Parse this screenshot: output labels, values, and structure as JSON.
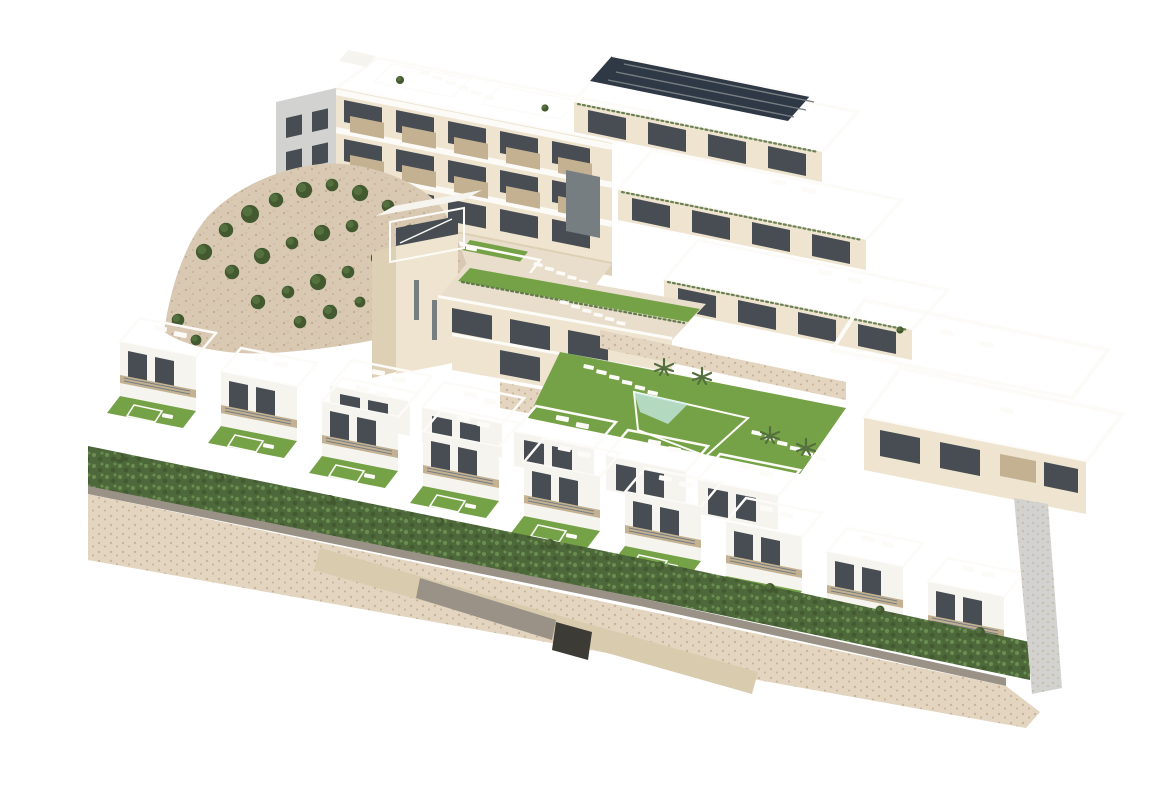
{
  "meta": {
    "title": "Aerial 3D architectural render of a hillside residential development",
    "background": "#ffffff"
  },
  "palette": {
    "bg": "#ffffff",
    "white_wall": "#f6f4ee",
    "parapet": "#fcfbf8",
    "cream_wall": "#eee4cf",
    "cream_wall_dark": "#ddd0b4",
    "tan_balcony": "#c3b192",
    "roof_deck": "#e8decb",
    "roof_deck_light": "#f0e9d8",
    "grey_wall": "#d2d3d0",
    "glass_dark": "#474d52",
    "glass_mid": "#767e82",
    "pool_water": "#8ed2d8",
    "pool_light": "#c8ecea",
    "pool_deep": "#55b8c6",
    "lawn": "#76a247",
    "lawn_dark": "#5d8a38",
    "hedge": "#4d683a",
    "hedge_light": "#6b8d50",
    "tree": "#55703f",
    "tree_dark": "#43592f",
    "rock_sand": "#d9c9b3",
    "rock_speck": "#c2ac92",
    "stone_wall": "#e3d5c0",
    "stone_speck": "#c9b49c",
    "ramp": "#d8cbae",
    "ramp_grey": "#9a9287",
    "opening_dark": "#3c3b36",
    "solar": "#2f3845"
  },
  "scene": {
    "description": "Aerial 3D render of a coastal hillside residential complex: a large apartment block with tan balcony panels and roof terraces, a terraced apartment building with a solar-panel roof, a curved apartment block on the right, an elevator tower, a building with a planted green roof edge, two communal swimming pools with sun loungers and palms, two rows of white townhouses each with a private turquoise pool and lawn, a rocky hillside with olive shrubs, a long green hedge and a speckled stone retaining wall with an access ramp and garage opening at the base",
    "areas": {
      "apartment_block_left": {
        "floors_visible": 3,
        "balconies_per_floor": 5,
        "roof_terraces": true
      },
      "terraced_block_right": {
        "terrace_steps": 3,
        "has_solar_roof": true
      },
      "apartment_block_far_right": {
        "curved_roof_terraces": 2
      },
      "elevator_tower": {
        "glass_top": true
      },
      "green_roof_building": {
        "planted_roof_edge": true
      },
      "townhouse_front_row": {
        "count": 9
      },
      "townhouse_back_row": {
        "count": 5
      },
      "communal_pools": 2,
      "private_pools": 14,
      "rocky_hillside_bushes": 24,
      "front_hedge": true,
      "stone_base_with_ramp_and_garage": true
    }
  }
}
